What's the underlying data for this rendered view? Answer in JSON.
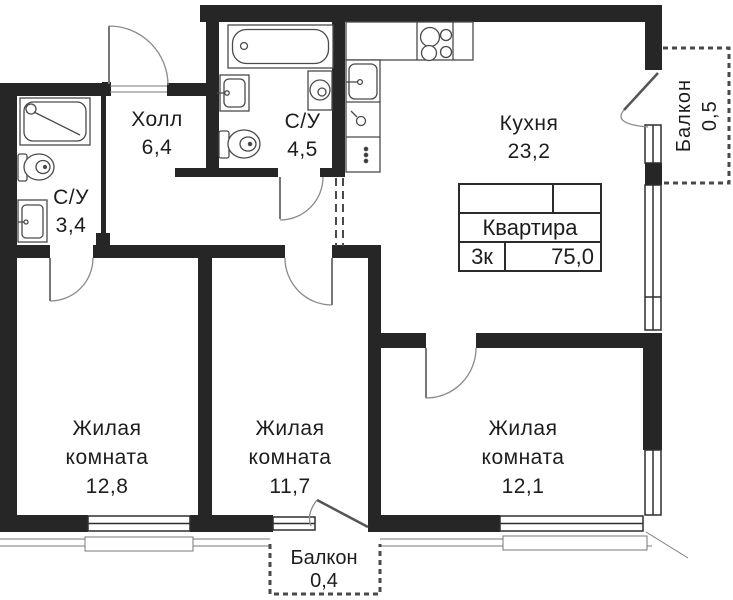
{
  "plan": {
    "hall": {
      "name": "Холл",
      "area": "6,4"
    },
    "bathroom_large": {
      "name": "С/У",
      "area": "4,5"
    },
    "bathroom_small": {
      "name": "С/У",
      "area": "3,4"
    },
    "kitchen": {
      "name": "Кухня",
      "area": "23,2"
    },
    "room_left": {
      "name_line1": "Жилая",
      "name_line2": "комната",
      "area": "12,8"
    },
    "room_middle": {
      "name_line1": "Жилая",
      "name_line2": "комната",
      "area": "11,7"
    },
    "room_right": {
      "name_line1": "Жилая",
      "name_line2": "комната",
      "area": "12,1"
    },
    "balcony_right": {
      "name": "Балкон",
      "area": "0,5"
    },
    "balcony_bottom": {
      "name": "Балкон",
      "area": "0,4"
    }
  },
  "info_table": {
    "title": "Квартира",
    "rooms": "3к",
    "area": "75,0"
  },
  "colors": {
    "wall": "#262626",
    "line": "#8a8a8a",
    "fixture": "#4a4a4a",
    "text": "#1d1d1d"
  }
}
